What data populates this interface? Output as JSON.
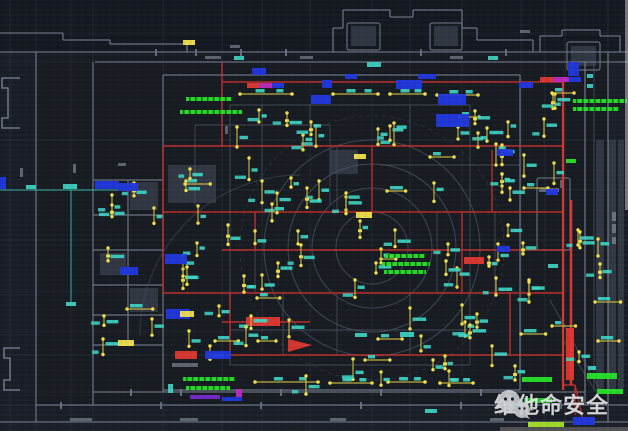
{
  "meta": {
    "title": "fire-alarm-floor-plan-cad-view",
    "canvas_w": 628,
    "canvas_h": 431
  },
  "watermark": {
    "text": "维他命安全",
    "icon": "wechat-icon"
  },
  "palette": {
    "bg": "#171b22",
    "bg_top": "#141820",
    "bg_outer": "#1b2029",
    "wall_bright": "#8b94a2",
    "wall_mid": "#6d7684",
    "wall_faint": "#454d59",
    "grid": "#2d343f",
    "zone_red": "#c5302c",
    "zone_red_bright": "#e03832",
    "device_yellow": "#c9b944",
    "device_dot": "#f2e14d",
    "tag_cyan": "#3ed8c8",
    "annot_green": "#28e32a",
    "annot_chartreuse": "#a8e32a",
    "blob_blue": "#2138e0",
    "bar_magenta": "#c02ac0",
    "bar_purple": "#7a2ad0",
    "smudge": "#98a1ad",
    "watermark_white": "#e9eced"
  },
  "drawing": {
    "grid_vx": [
      10,
      36,
      71,
      93,
      163,
      222,
      262,
      310,
      372,
      410,
      462,
      521,
      545,
      565,
      608
    ],
    "grid_hy": [
      33,
      62,
      140,
      190,
      240,
      292,
      332,
      355,
      392,
      405,
      422
    ],
    "walls_mid": [
      [
        0,
        33,
        63,
        33
      ],
      [
        63,
        33,
        63,
        40
      ],
      [
        63,
        40,
        110,
        40
      ],
      [
        110,
        40,
        110,
        44
      ],
      [
        110,
        44,
        187,
        44
      ],
      [
        187,
        44,
        187,
        52
      ],
      [
        0,
        52,
        628,
        52
      ],
      [
        95,
        62,
        628,
        62
      ],
      [
        333,
        52,
        333,
        28
      ],
      [
        333,
        28,
        343,
        28
      ],
      [
        343,
        28,
        343,
        10
      ],
      [
        343,
        10,
        390,
        10
      ],
      [
        390,
        10,
        390,
        17
      ],
      [
        390,
        17,
        413,
        17
      ],
      [
        413,
        17,
        413,
        10
      ],
      [
        413,
        10,
        462,
        10
      ],
      [
        462,
        10,
        462,
        28
      ],
      [
        462,
        28,
        477,
        28
      ],
      [
        477,
        28,
        477,
        40
      ],
      [
        477,
        40,
        533,
        40
      ],
      [
        533,
        40,
        533,
        52
      ],
      [
        540,
        52,
        540,
        36
      ],
      [
        540,
        36,
        562,
        36
      ],
      [
        562,
        36,
        562,
        30
      ],
      [
        562,
        30,
        600,
        30
      ],
      [
        600,
        30,
        600,
        36
      ],
      [
        600,
        36,
        620,
        36
      ],
      [
        620,
        36,
        620,
        52
      ],
      [
        36,
        52,
        36,
        422
      ],
      [
        93,
        62,
        93,
        405
      ],
      [
        608,
        52,
        608,
        422
      ],
      [
        585,
        62,
        585,
        405
      ],
      [
        163,
        75,
        163,
        392
      ],
      [
        93,
        392,
        585,
        392
      ],
      [
        36,
        405,
        628,
        405
      ],
      [
        0,
        422,
        628,
        422
      ],
      [
        93,
        180,
        163,
        180
      ],
      [
        93,
        215,
        163,
        215
      ],
      [
        93,
        250,
        163,
        250
      ],
      [
        93,
        285,
        163,
        285
      ],
      [
        93,
        315,
        163,
        315
      ],
      [
        93,
        345,
        163,
        345
      ],
      [
        128,
        180,
        128,
        345
      ],
      [
        163,
        75,
        520,
        75
      ],
      [
        520,
        75,
        520,
        390
      ],
      [
        163,
        390,
        520,
        390
      ]
    ],
    "walls_faint": [
      [
        230,
        105,
        470,
        105
      ],
      [
        230,
        105,
        230,
        365
      ],
      [
        470,
        105,
        470,
        365
      ],
      [
        230,
        365,
        470,
        365
      ],
      [
        262,
        105,
        262,
        212
      ],
      [
        310,
        105,
        310,
        146
      ],
      [
        410,
        105,
        410,
        146
      ],
      [
        337,
        146,
        337,
        212
      ],
      [
        437,
        212,
        437,
        293
      ],
      [
        283,
        293,
        283,
        355
      ],
      [
        337,
        293,
        337,
        355
      ],
      [
        410,
        293,
        410,
        355
      ],
      [
        495,
        212,
        495,
        293
      ],
      [
        195,
        125,
        330,
        125
      ],
      [
        195,
        125,
        195,
        205
      ],
      [
        330,
        125,
        330,
        205
      ],
      [
        380,
        165,
        520,
        165
      ],
      [
        230,
        330,
        470,
        330
      ],
      [
        255,
        212,
        255,
        293
      ],
      [
        594,
        62,
        594,
        390
      ],
      [
        550,
        300,
        600,
        390
      ],
      [
        563,
        340,
        596,
        392
      ]
    ],
    "wall_rects": [
      [
        347,
        23,
        33,
        27
      ],
      [
        430,
        23,
        32,
        27
      ],
      [
        567,
        42,
        33,
        28
      ],
      [
        537,
        178,
        33,
        72
      ]
    ],
    "niches": [
      [
        [
          20,
          78
        ],
        [
          2,
          78
        ],
        [
          2,
          88
        ],
        [
          8,
          88
        ],
        [
          8,
          118
        ],
        [
          2,
          118
        ],
        [
          2,
          128
        ],
        [
          20,
          128
        ]
      ],
      [
        [
          20,
          348
        ],
        [
          4,
          348
        ],
        [
          4,
          358
        ],
        [
          10,
          358
        ],
        [
          10,
          380
        ],
        [
          4,
          380
        ],
        [
          4,
          390
        ],
        [
          20,
          390
        ]
      ]
    ],
    "gray_fills": [
      [
        130,
        182,
        28,
        28
      ],
      [
        100,
        253,
        26,
        22
      ],
      [
        130,
        288,
        28,
        24
      ],
      [
        168,
        165,
        48,
        38
      ],
      [
        330,
        150,
        28,
        24
      ],
      [
        351,
        26,
        25,
        20
      ],
      [
        434,
        26,
        24,
        20
      ],
      [
        571,
        46,
        25,
        20
      ],
      [
        596,
        140,
        8,
        250
      ],
      [
        608,
        140,
        8,
        250
      ],
      [
        618,
        140,
        6,
        250
      ]
    ],
    "circles": {
      "cx": 372,
      "cy": 248,
      "radii": [
        36,
        60,
        84,
        108
      ],
      "dashed_r": 132
    },
    "arc_path": "M140,335 A160,160 0 0 1 300,175",
    "red_lines": [
      {
        "s": [
          222,
          82,
          563,
          82
        ]
      },
      {
        "s": [
          163,
          146,
          563,
          146
        ]
      },
      {
        "s": [
          163,
          212,
          563,
          212
        ]
      },
      {
        "s": [
          222,
          250,
          563,
          250
        ]
      },
      {
        "s": [
          163,
          293,
          563,
          293
        ]
      },
      {
        "s": [
          230,
          355,
          563,
          355
        ]
      },
      {
        "s": [
          222,
          322,
          310,
          322
        ]
      },
      {
        "s": [
          563,
          385,
          575,
          385
        ]
      },
      {
        "s": [
          222,
          62,
          222,
          146
        ]
      },
      {
        "s": [
          163,
          146,
          163,
          293
        ]
      },
      {
        "s": [
          372,
          146,
          372,
          212
        ]
      },
      {
        "s": [
          462,
          212,
          462,
          293
        ]
      },
      {
        "s": [
          255,
          212,
          255,
          250
        ]
      },
      {
        "s": [
          230,
          293,
          230,
          355
        ]
      },
      {
        "s": [
          510,
          293,
          510,
          355
        ]
      },
      {
        "s": [
          492,
          150,
          492,
          212
        ]
      },
      {
        "s": [
          563,
          82,
          563,
          390
        ],
        "w": 2.2
      },
      {
        "s": [
          571,
          200,
          571,
          385
        ],
        "w": 2.6
      },
      {
        "s": [
          575,
          385,
          575,
          415
        ]
      },
      {
        "s": [
          575,
          385,
          583,
          420
        ]
      }
    ],
    "red_fills": [
      [
        246,
        317,
        34,
        9
      ],
      [
        464,
        257,
        20,
        7
      ],
      [
        175,
        351,
        22,
        8
      ],
      [
        566,
        328,
        8,
        52
      ],
      [
        540,
        77,
        13,
        5
      ],
      [
        247,
        83,
        12,
        5
      ]
    ],
    "red_arrow": "288,339 312,345 288,352",
    "magenta_fills": [
      [
        553,
        77,
        16,
        5
      ],
      [
        259,
        83,
        13,
        5
      ],
      [
        236,
        389,
        6,
        8
      ]
    ],
    "purple_fills": [
      [
        190,
        395,
        30,
        4
      ]
    ],
    "blue_blobs": [
      [
        311,
        95,
        20,
        9
      ],
      [
        396,
        80,
        26,
        9
      ],
      [
        438,
        94,
        28,
        11
      ],
      [
        436,
        114,
        33,
        13
      ],
      [
        568,
        62,
        11,
        14
      ],
      [
        95,
        181,
        24,
        8
      ],
      [
        118,
        183,
        20,
        8
      ],
      [
        0,
        177,
        6,
        12
      ],
      [
        165,
        254,
        22,
        10
      ],
      [
        120,
        267,
        18,
        8
      ],
      [
        166,
        309,
        24,
        10
      ],
      [
        497,
        149,
        16,
        7
      ],
      [
        546,
        189,
        12,
        6
      ],
      [
        497,
        246,
        13,
        6
      ],
      [
        205,
        351,
        26,
        8
      ],
      [
        222,
        397,
        20,
        4
      ],
      [
        573,
        417,
        22,
        8
      ],
      [
        345,
        74,
        12,
        5
      ],
      [
        418,
        74,
        18,
        5
      ],
      [
        519,
        82,
        14,
        6
      ],
      [
        252,
        68,
        14,
        7
      ],
      [
        322,
        80,
        10,
        8
      ],
      [
        569,
        77,
        12,
        5
      ],
      [
        272,
        83,
        12,
        5
      ]
    ],
    "green_text_bars": [
      [
        186,
        97,
        46,
        4
      ],
      [
        180,
        110,
        62,
        4
      ],
      [
        573,
        99,
        54,
        4
      ],
      [
        573,
        107,
        46,
        4
      ],
      [
        385,
        254,
        40,
        4
      ],
      [
        382,
        262,
        48,
        4
      ],
      [
        384,
        270,
        42,
        4
      ],
      [
        183,
        377,
        52,
        4
      ],
      [
        186,
        386,
        44,
        4
      ]
    ],
    "green_solid_bars": [
      [
        522,
        377,
        30,
        5
      ],
      [
        524,
        398,
        28,
        5
      ],
      [
        587,
        373,
        30,
        6
      ],
      [
        597,
        389,
        26,
        5
      ],
      [
        566,
        159,
        10,
        4
      ]
    ],
    "chartreuse_bars": [
      [
        528,
        422,
        36,
        5
      ]
    ],
    "yellow_tags": [
      [
        356,
        212,
        16,
        6
      ],
      [
        180,
        311,
        14,
        6
      ],
      [
        118,
        340,
        16,
        6
      ],
      [
        354,
        154,
        12,
        5
      ],
      [
        183,
        40,
        12,
        5
      ]
    ],
    "cyan_tags": [
      [
        367,
        62,
        14,
        5
      ],
      [
        488,
        56,
        10,
        4
      ],
      [
        234,
        56,
        10,
        4
      ],
      [
        63,
        184,
        14,
        5
      ],
      [
        26,
        185,
        10,
        4
      ],
      [
        66,
        302,
        10,
        4
      ],
      [
        587,
        74,
        6,
        4
      ],
      [
        587,
        84,
        6,
        4
      ],
      [
        588,
        366,
        8,
        4
      ],
      [
        400,
        332,
        14,
        5
      ],
      [
        425,
        409,
        12,
        4
      ],
      [
        355,
        333,
        12,
        4
      ],
      [
        548,
        264,
        10,
        4
      ],
      [
        168,
        384,
        5,
        9
      ]
    ],
    "cyan_lines": [
      [
        0,
        190,
        93,
        190
      ],
      [
        71,
        190,
        71,
        305
      ],
      [
        93,
        190,
        118,
        190
      ]
    ],
    "buses": [
      {
        "y": 94,
        "x1": 240,
        "x2": 292
      },
      {
        "y": 94,
        "x1": 333,
        "x2": 378
      },
      {
        "y": 94,
        "x1": 390,
        "x2": 425
      },
      {
        "y": 95,
        "x1": 437,
        "x2": 478
      },
      {
        "y": 382,
        "x1": 255,
        "x2": 318
      },
      {
        "y": 383,
        "x1": 330,
        "x2": 372
      },
      {
        "y": 382,
        "x1": 388,
        "x2": 425
      },
      {
        "y": 383,
        "x1": 440,
        "x2": 473
      }
    ],
    "device_regions": [
      [
        235,
        106,
        95,
        40,
        6
      ],
      [
        335,
        104,
        175,
        42,
        11
      ],
      [
        175,
        118,
        42,
        88,
        4
      ],
      [
        235,
        150,
        95,
        55,
        7
      ],
      [
        335,
        150,
        220,
        55,
        11
      ],
      [
        175,
        216,
        155,
        72,
        11
      ],
      [
        340,
        216,
        120,
        72,
        9
      ],
      [
        468,
        214,
        88,
        74,
        7
      ],
      [
        175,
        296,
        155,
        54,
        9
      ],
      [
        340,
        296,
        215,
        54,
        10
      ],
      [
        240,
        356,
        280,
        26,
        8
      ],
      [
        96,
        183,
        62,
        158,
        9
      ],
      [
        568,
        148,
        34,
        212,
        7
      ],
      [
        523,
        93,
        34,
        48,
        4
      ]
    ],
    "smudges": [
      [
        205,
        56,
        16,
        3
      ],
      [
        300,
        56,
        13,
        3
      ],
      [
        450,
        56,
        13,
        3
      ],
      [
        230,
        45,
        10,
        3
      ],
      [
        70,
        418,
        22,
        3
      ],
      [
        180,
        418,
        18,
        3
      ],
      [
        330,
        418,
        16,
        3
      ],
      [
        490,
        418,
        14,
        3
      ],
      [
        172,
        363,
        26,
        4
      ],
      [
        612,
        212,
        4,
        9
      ],
      [
        612,
        224,
        4,
        9
      ],
      [
        612,
        237,
        4,
        7
      ],
      [
        20,
        168,
        3,
        9
      ],
      [
        73,
        164,
        3,
        9
      ],
      [
        118,
        163,
        8,
        3
      ],
      [
        225,
        126,
        3,
        8
      ],
      [
        520,
        30,
        10,
        3
      ],
      [
        560,
        180,
        3,
        8
      ],
      [
        539,
        188,
        20,
        4
      ]
    ],
    "ticks": [
      [
        155,
        49
      ],
      [
        195,
        49
      ],
      [
        240,
        49
      ],
      [
        285,
        49
      ],
      [
        420,
        49
      ],
      [
        505,
        49
      ],
      [
        130,
        389
      ],
      [
        180,
        389
      ],
      [
        280,
        389
      ],
      [
        380,
        389
      ],
      [
        480,
        389
      ],
      [
        60,
        402
      ],
      [
        160,
        402
      ],
      [
        260,
        402
      ],
      [
        360,
        402
      ],
      [
        460,
        402
      ],
      [
        560,
        402
      ]
    ],
    "edge_artifacts": {
      "right_strip": [
        625,
        0,
        3,
        210
      ],
      "bottom_beige": [
        500,
        427,
        128,
        4
      ]
    }
  }
}
